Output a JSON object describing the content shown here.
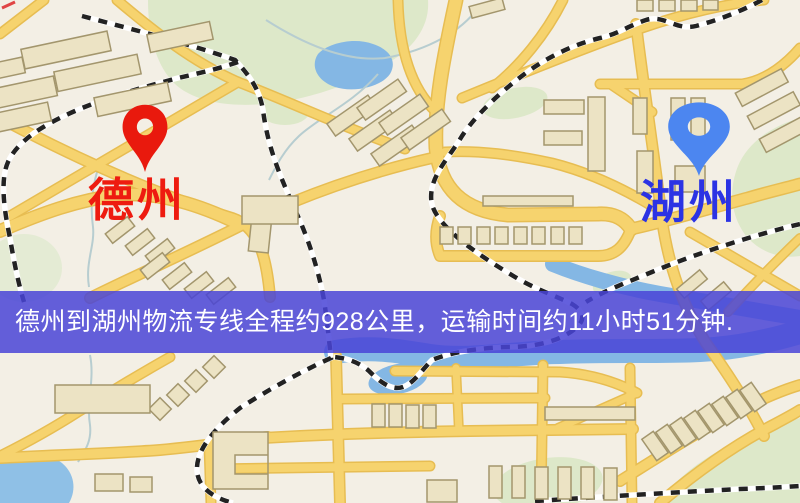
{
  "banner": {
    "text": "德州到湖州物流专线全程约928公里，运输时间约11小时51分钟."
  },
  "markers": {
    "origin": {
      "label": "德州",
      "pin_color": "#e9190d",
      "label_color": "#ee1b10"
    },
    "destination": {
      "label": "湖州",
      "pin_color": "#4c86f0",
      "label_color": "#2b33e4"
    }
  },
  "route_info": {
    "origin": "德州",
    "destination": "湖州",
    "distance": "约928公里",
    "duration": "约11小时51分钟"
  },
  "palette": {
    "map_background": "#f3efe5",
    "road": "#f6d36e",
    "road_casing": "#e7bd52",
    "building": "#ece3c4",
    "building_border": "#a3966d",
    "park": "#dde8c9",
    "water": "#84b7e4",
    "railway_dark": "#222222",
    "banner_overlay": "#4944d7"
  }
}
